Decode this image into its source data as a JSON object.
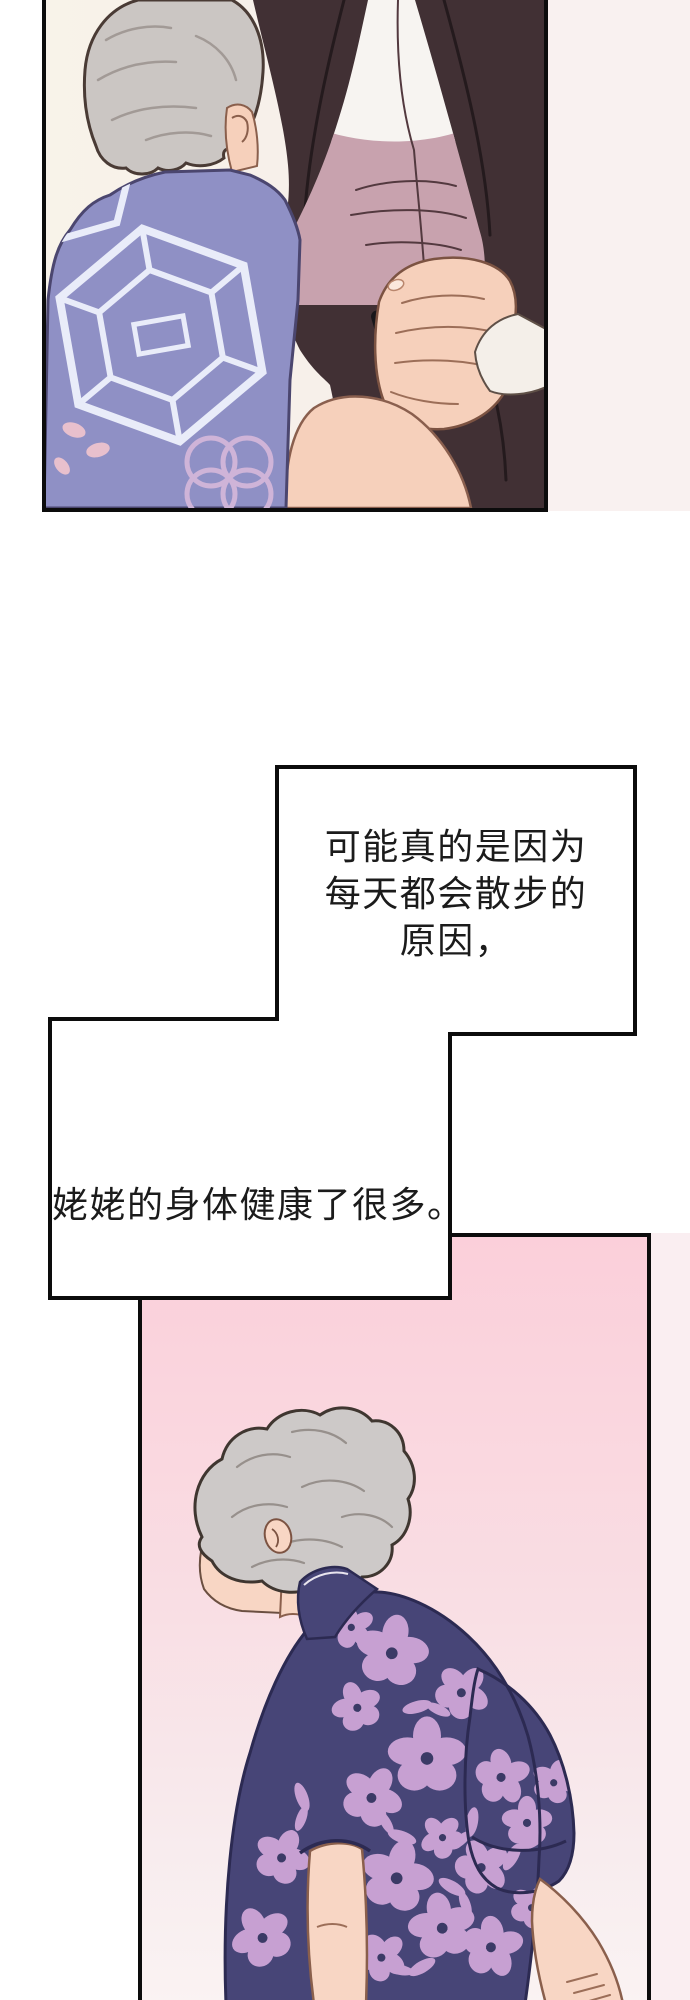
{
  "captions": {
    "box1": {
      "line1": "可能真的是因为",
      "line2": "每天都会散步的",
      "line3": "原因，"
    },
    "box2": {
      "text": "姥姥的身体健康了很多。"
    }
  },
  "panels": {
    "panel1": {
      "description": "Elderly woman with gray hair in a purple patterned shirt seen from behind, beside a man in a dark suit holding a black card"
    },
    "panel2": {
      "description": "Elderly woman with curly gray hair in a navy floral shirt, seen from behind against a pink background, hands clasped behind her back"
    }
  },
  "colors": {
    "border": "#0c0c0c",
    "text": "#1b1b1b",
    "caption_bg": "#ffffff",
    "p1_bg_left": "#f8f3e9",
    "p1_bg_right": "#f6edeb",
    "p1_hair": "#cbc6c3",
    "p1_hair_line": "#a29a96",
    "outline": "#4a3b35",
    "skin": "#f6d0bb",
    "skin_line": "#9c6e58",
    "p1_shirt": "#8f90c5",
    "p1_shirt_edge": "#4b466f",
    "p1_shirt_pattern": "#e9ecf9",
    "p1_shirt_rings": "#cfb4d8",
    "p1_shirt_petal": "#e8c0cd",
    "suit": "#413034",
    "suit_line": "#241a1d",
    "dress_shirt": "#f7f4f1",
    "dress_shirt_shadow": "#c8a2ae",
    "shadow_line": "#53393f",
    "card": "#17161a",
    "cuff": "#f4efe9",
    "cuff_line": "#5f5047",
    "p2_bg_top": "#fbcfda",
    "p2_bg_mid": "#f9dde3",
    "p2_bg_low": "#f8ecee",
    "p2_bg_bottom": "#faf3f3",
    "p2_hair": "#cdc9c8",
    "p2_hair_line": "#97908c",
    "p2_skin": "#f8d6c4",
    "p2_shirt_navy": "#474577",
    "p2_shirt_line": "#2c2a52",
    "p2_flower": "#c7a0d2",
    "p2_flower_center": "#3b3a66",
    "margin_tint_1": "#f9f1f0",
    "margin_tint_2": "#faeef1"
  }
}
